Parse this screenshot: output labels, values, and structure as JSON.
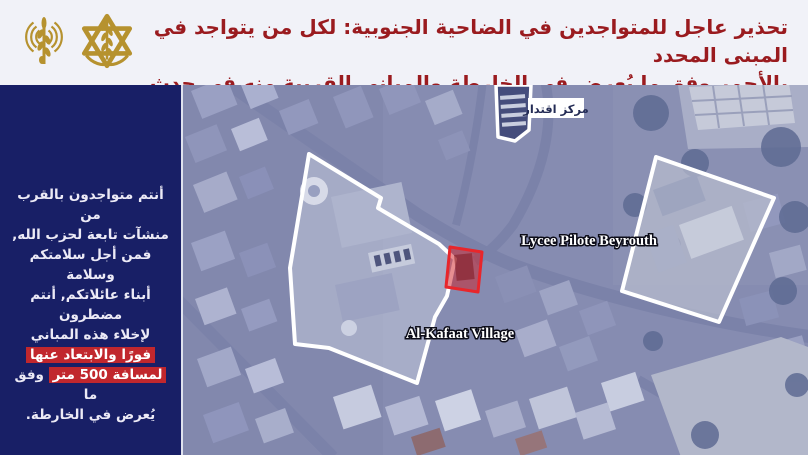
{
  "header": {
    "line1": "تحذير عاجل للمتواجدين في الضاحية الجنوبية: لكل من يتواجد في المبنى المحدد",
    "line2": "بالأحمر وفق ما يُعرض في الخارطة والمباني القريبة منه في حدث",
    "text_color": "#9a1b1f",
    "background_color": "#f1f2f8",
    "emblem_color": "#b6922f",
    "icons": [
      "broadcast-antenna-emblem",
      "idf-military-emblem"
    ]
  },
  "sidebar": {
    "background_color": "#181f66",
    "highlight_color": "#c1272d",
    "line1": "أنتم متواجدون بالقرب من",
    "line2": "منشآت تابعة لحزب الله,",
    "line3": "فمن أجل سلامتكم وسلامة",
    "line4": "أبناء عائلاتكم, أنتم مضطرون",
    "line5": "لإخلاء هذه المباني",
    "line6_highlighted": "فورًا والابتعاد عنها",
    "line7_highlighted": "لمسافة 500 متر",
    "line7_rest": "وفق ما",
    "line8": "يُعرض في الخارطة."
  },
  "map": {
    "type": "annotated-satellite-map",
    "labels": {
      "iqtidar_center": "مركز اقتدار",
      "lycee": "Lycee Pilote Beyrouth",
      "kafaat_village": "Al-Kafaat Village"
    },
    "target_building_color": "#e22427",
    "outline_color": "#ffffff"
  }
}
